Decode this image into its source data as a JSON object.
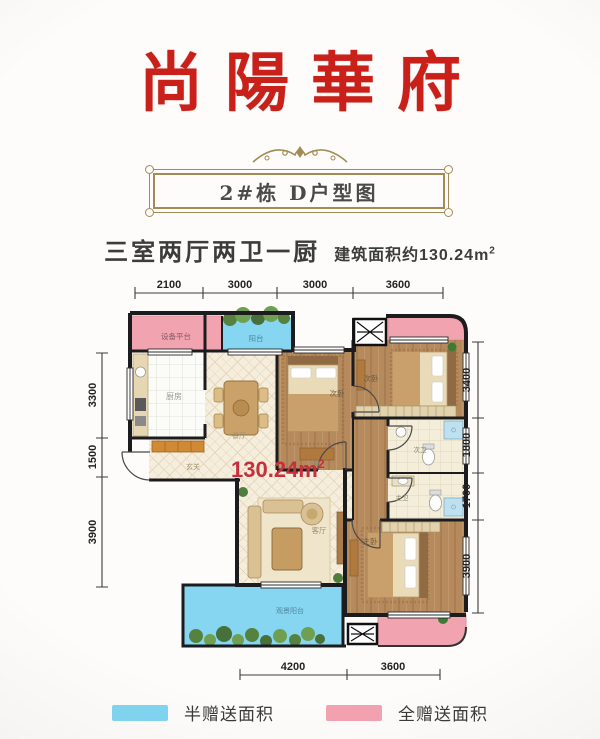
{
  "title": "尚陽華府",
  "banner": {
    "label": "2#栋  D户型图"
  },
  "summary": {
    "layout": "三室两厅两卫一厨",
    "area": "建筑面积约130.24m",
    "area_sup": "2"
  },
  "plan": {
    "area_label": "130.24m",
    "area_sup": "2",
    "rooms": {
      "equipment": "设备平台",
      "balcony_top": "阳台",
      "kitchen": "厨房",
      "dining": "餐厅",
      "entry": "玄关",
      "hallway": "过道",
      "living": "客厅",
      "bedroom_mid": "次卧",
      "bedroom_right": "次卧",
      "master": "主卧",
      "bath_second": "次卫",
      "bath_master": "主卫",
      "balcony_view": "观景阳台"
    },
    "dims": {
      "top": [
        "2100",
        "3000",
        "3000",
        "3600"
      ],
      "left": [
        "3300",
        "1500",
        "3900"
      ],
      "right": [
        "3400",
        "1800",
        "1700",
        "3900"
      ],
      "bottom": [
        "4200",
        "3600"
      ]
    }
  },
  "legend": {
    "items": [
      {
        "label": "半赠送面积",
        "color": "#7fd3ef"
      },
      {
        "label": "全赠送面积",
        "color": "#f2a2ae"
      }
    ]
  },
  "colors": {
    "title_red": "#c9201a",
    "gold": "#a28b55",
    "pink": "#f1a3af",
    "blue": "#86d6f1",
    "area_red": "#c5303c"
  }
}
